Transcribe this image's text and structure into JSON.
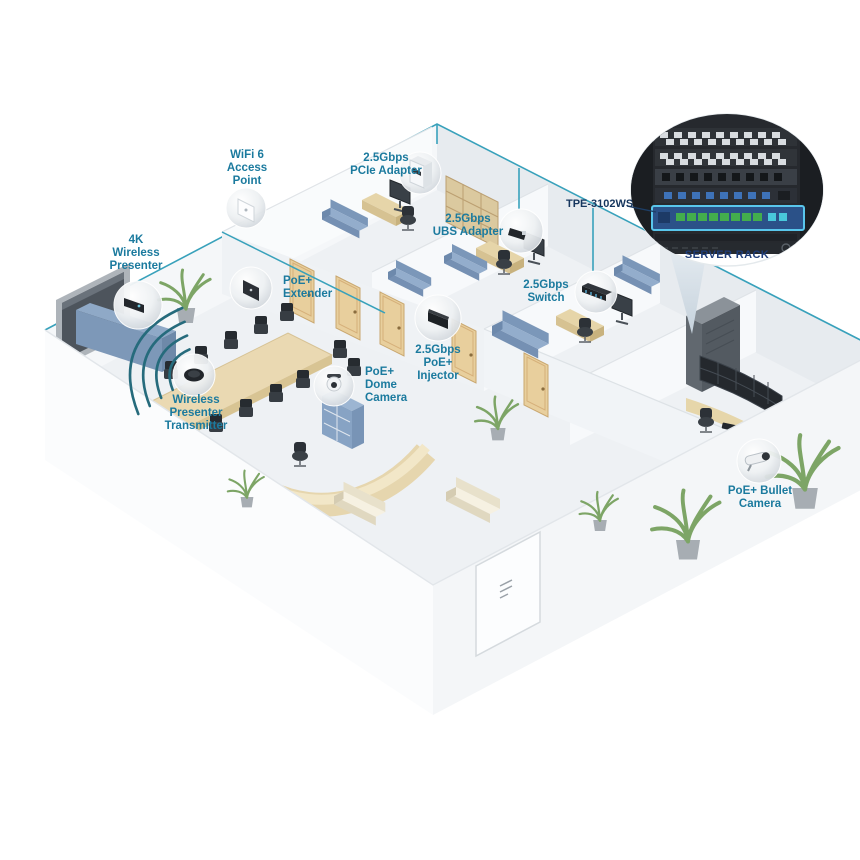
{
  "callouts": [
    {
      "id": "wifi6-access-point",
      "lines": [
        "WiFi 6",
        "Access",
        "Point"
      ]
    },
    {
      "id": "pcie-adapter",
      "lines": [
        "2.5Gbps",
        "PCIe Adapter"
      ]
    },
    {
      "id": "usb-adapter",
      "lines": [
        "2.5Gbps",
        "UBS Adapter"
      ]
    },
    {
      "id": "switch",
      "lines": [
        "2.5Gbps",
        "Switch"
      ]
    },
    {
      "id": "4k-wireless-presenter",
      "lines": [
        "4K",
        "Wireless",
        "Presenter"
      ]
    },
    {
      "id": "poe-extender",
      "lines": [
        "PoE+",
        "Extender"
      ]
    },
    {
      "id": "wireless-presenter-transmitter",
      "lines": [
        "Wireless",
        "Presenter",
        "Transmitter"
      ]
    },
    {
      "id": "poe-dome-camera",
      "lines": [
        "PoE+",
        "Dome",
        "Camera"
      ]
    },
    {
      "id": "poe-injector",
      "lines": [
        "2.5Gbps",
        "PoE+",
        "Injector"
      ]
    },
    {
      "id": "poe-bullet-camera",
      "lines": [
        "PoE+ Bullet",
        "Camera"
      ]
    }
  ],
  "rack_inset": {
    "model_label": "TPE-3102WS",
    "caption": "SERVER RACK"
  },
  "colors": {
    "label_text": "#1b7a9e",
    "connector_line": "#38a1bb",
    "model_label_text": "#16365e",
    "caption_text": "#1e3c78",
    "rack_highlight": "#59c6ec",
    "floor": "#eef1f4",
    "wall": "#f6f8fa",
    "sofa_blue": "#8ca8c8",
    "wood": "#e3d2a6",
    "plant_green": "#7da566"
  }
}
